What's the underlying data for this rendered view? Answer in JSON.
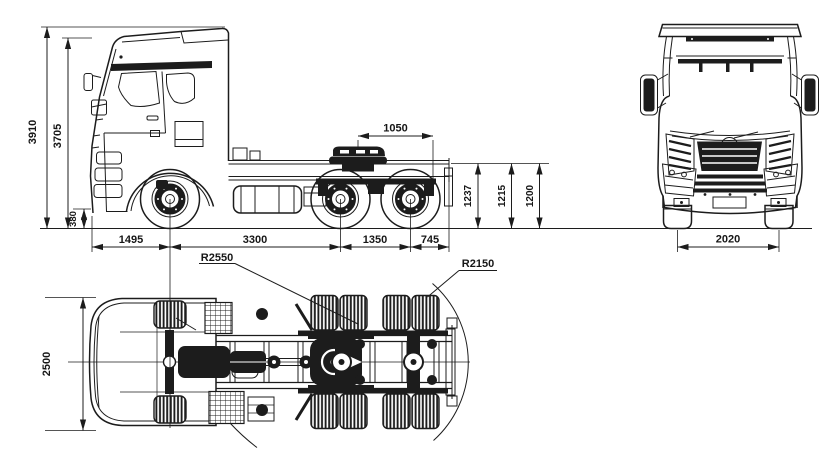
{
  "dimensions": {
    "side_view": {
      "overall_height": "3910",
      "cab_roof_height": "3705",
      "bumper_ground_clearance": "380",
      "front_overhang": "1495",
      "wheelbase": "3300",
      "rear_tandem_spacing": "1350",
      "rear_overhang": "745",
      "fifth_wheel_dim": "1050",
      "saddle_heights": [
        "1237",
        "1215",
        "1200"
      ]
    },
    "front_view": {
      "front_track_width": "2020"
    },
    "top_view": {
      "overall_width": "2500",
      "front_swing_radius": "R2550",
      "rear_swing_radius": "R2150"
    }
  },
  "colors": {
    "line_color": "#1c1c1c",
    "background": "#ffffff"
  }
}
